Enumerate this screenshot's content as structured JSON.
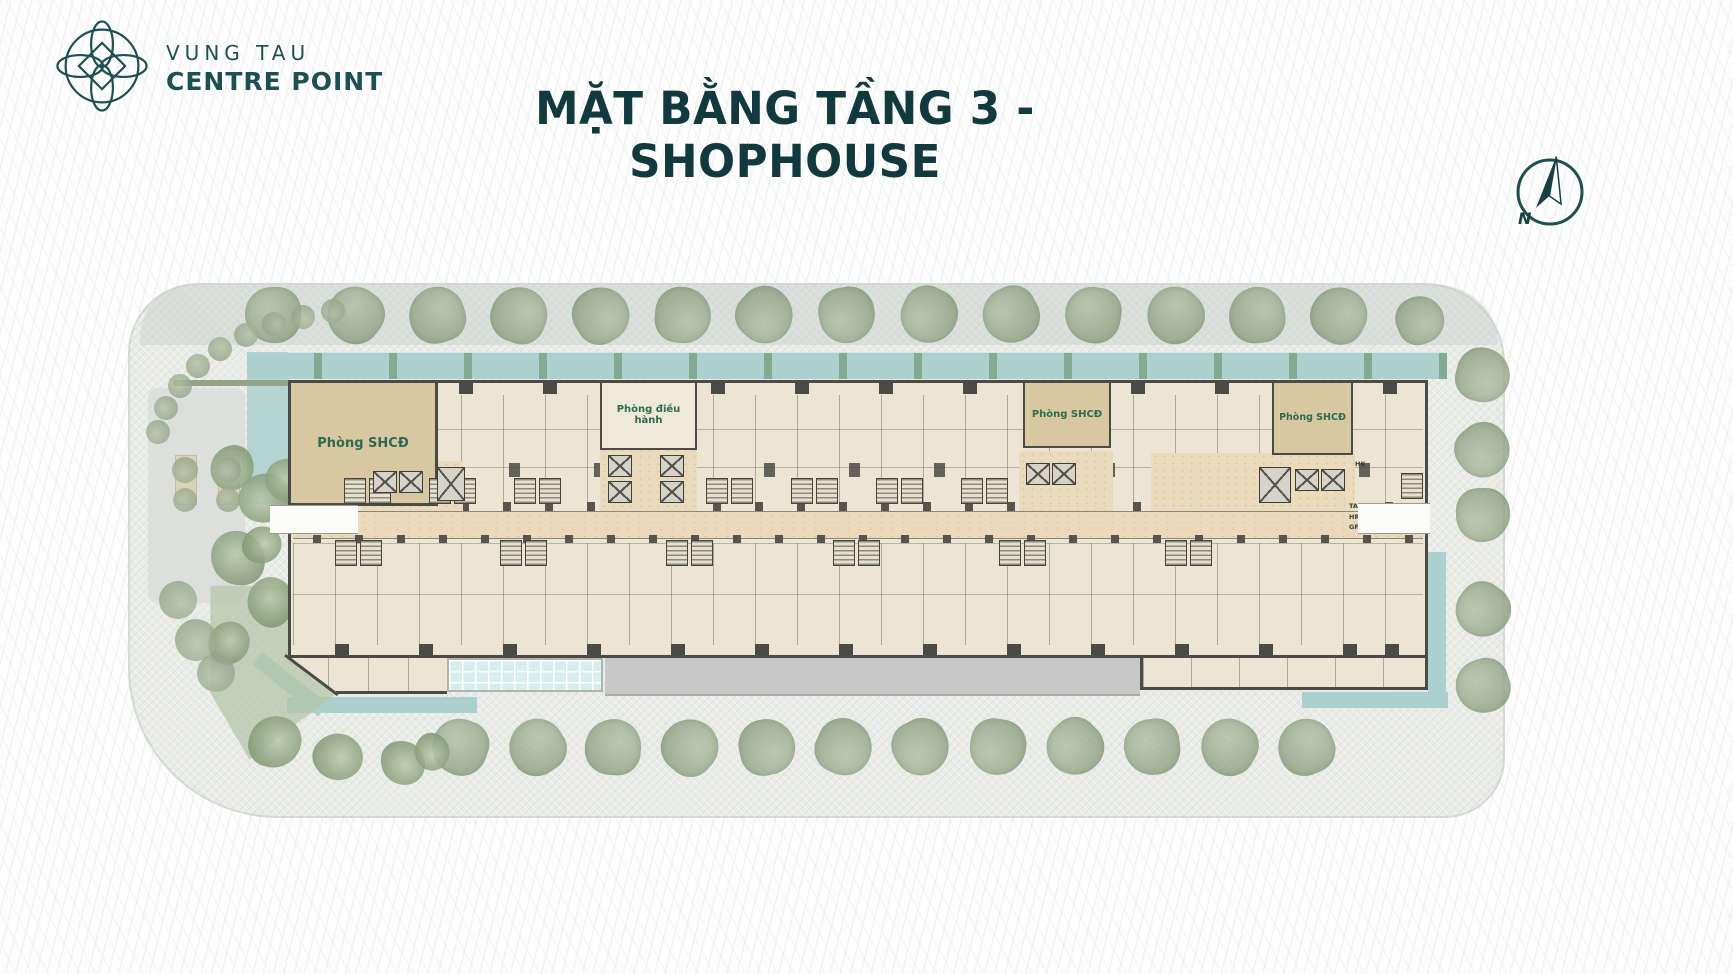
{
  "header": {
    "brand": {
      "line1": "VUNG TAU",
      "line2": "CENTRE POINT"
    },
    "title": "MẶT BẰNG TẦNG 3 - SHOPHOUSE",
    "compass_label": "N"
  },
  "plan": {
    "rooms": [
      {
        "id": "shcd-left",
        "label": "Phòng SHCĐ"
      },
      {
        "id": "dieu-hanh",
        "label": "Phòng điều hành"
      },
      {
        "id": "shcd-mid",
        "label": "Phòng SHCĐ"
      },
      {
        "id": "shcd-right",
        "label": "Phòng SHCĐ"
      }
    ],
    "service_labels": [
      "HK",
      "TAC",
      "HR",
      "GP"
    ]
  },
  "colors": {
    "brand_teal": "#1e4f52",
    "title_teal": "#12393d",
    "room_label_green": "#2e6a50",
    "room_tan": "#d8c8a2",
    "unit_cream": "#ece5d3",
    "corridor_tan": "#ecd9bb",
    "wall_gray": "#4a4a46",
    "water_teal": "#abd0cd",
    "tree_green": "#93a487",
    "plaza_gray": "#e9ebe7",
    "canopy_gray": "#c8c8c8",
    "skylight_blue": "#d7eeee"
  }
}
